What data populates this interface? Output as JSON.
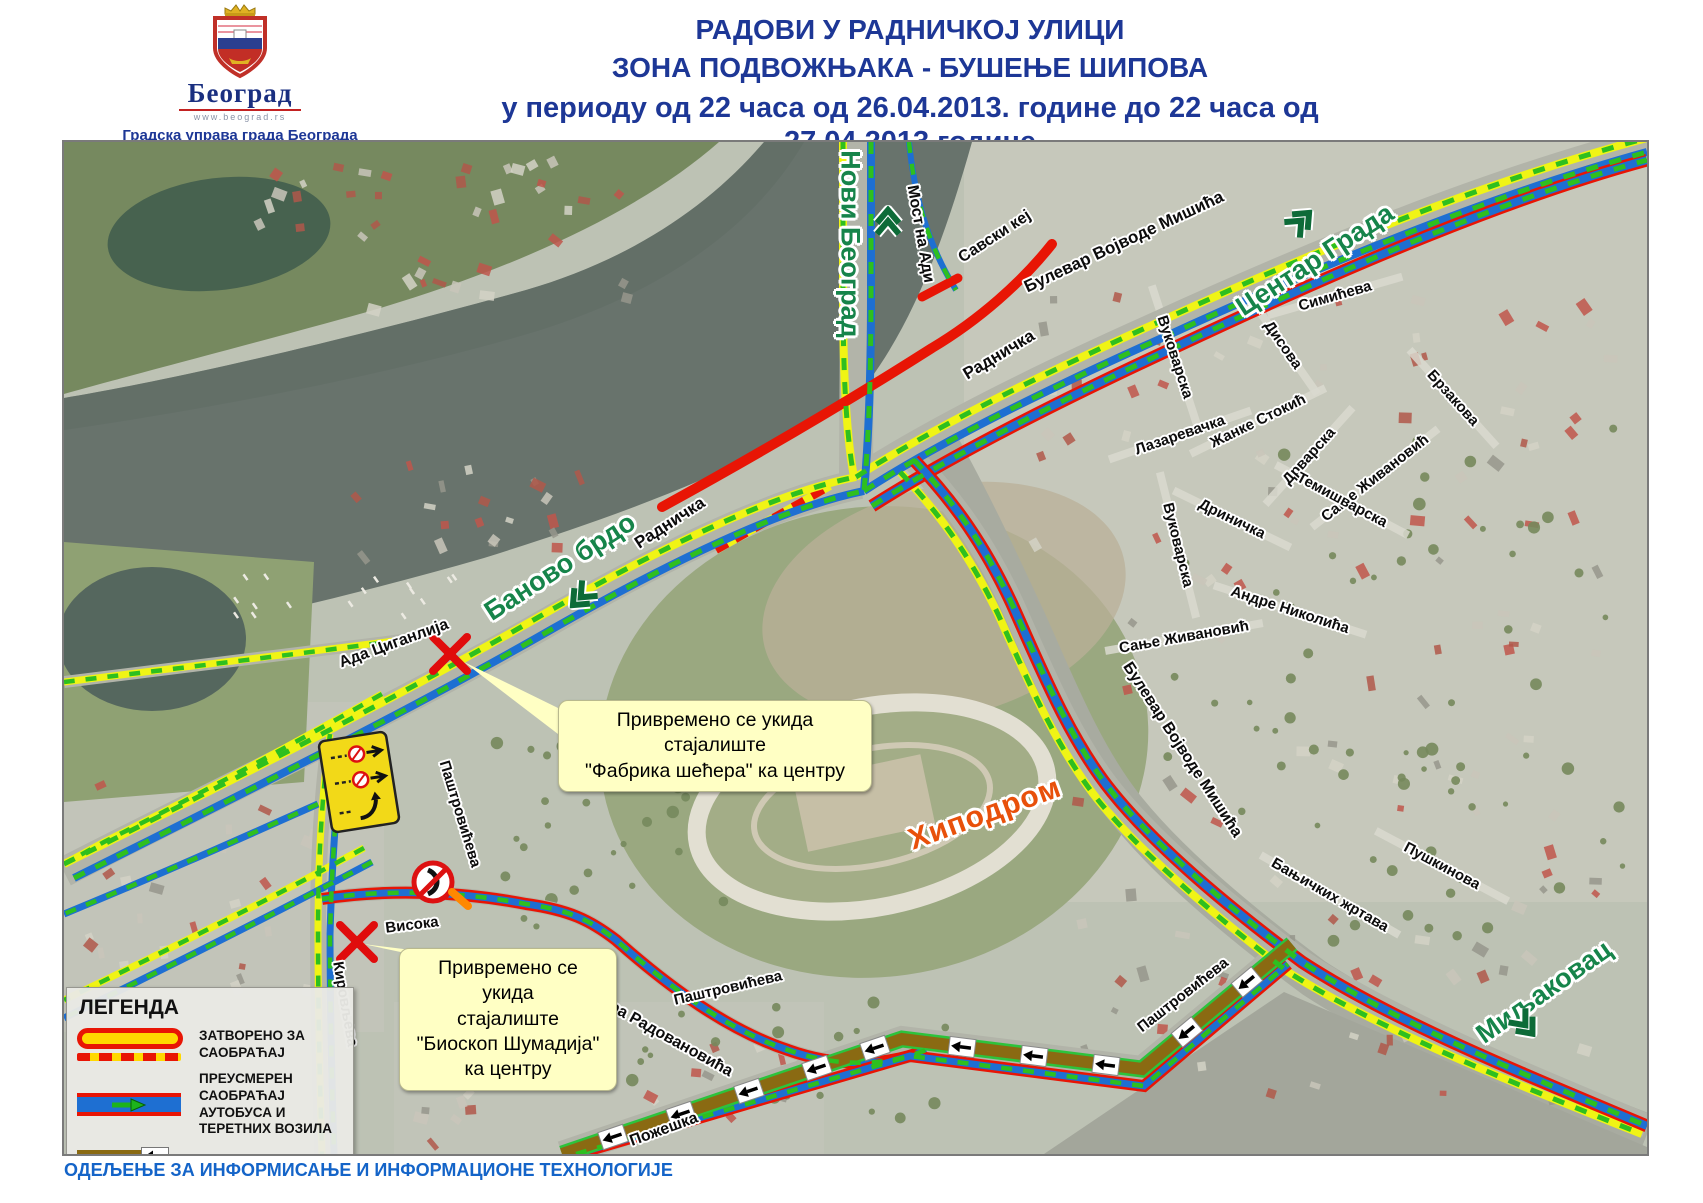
{
  "header": {
    "logo": {
      "city": "Београд",
      "url": "www.beograd.rs",
      "org1": "Градска управа града Београда",
      "org2": "Секретаријат за саобраћај"
    },
    "title1": "РАДОВИ У РАДНИЧКОЈ УЛИЦИ",
    "title2": "ЗОНА ПОДВОЖЊАКА - БУШЕЊЕ ШИПОВА",
    "title3": "у периоду од 22 часа од 26.04.2013. године до 22 часа од 27.04.2013.године"
  },
  "legend": {
    "title": "ЛЕГЕНДА",
    "items": [
      {
        "id": "closed",
        "label": "ЗАТВОРЕНО ЗА САОБРАЋАЈ"
      },
      {
        "id": "diverted",
        "label": "ПРЕУСМЕРЕН САОБРАЋАЈ\nАУТОБУСА И ТЕРЕТНИХ ВОЗИЛА"
      },
      {
        "id": "allowed",
        "label": "ДОЗВОЉЕН СМЕР"
      }
    ]
  },
  "footer": {
    "department": "ОДЕЉЕЊЕ ЗА ИНФОРМИСАЊЕ И ИНФОРМАЦИОНЕ ТЕХНОЛОГИЈЕ"
  },
  "map": {
    "callouts": [
      {
        "x": 494,
        "y": 558,
        "w": 292,
        "lines": "Привремено се укида стајалиште\n\"Фабрика шећера\" ка центру"
      },
      {
        "x": 335,
        "y": 806,
        "w": 196,
        "lines": "Привремено се укида\nстајалиште\n\"Биоскоп Шумадија\"\nка центру"
      }
    ],
    "area_label": {
      "text": "Хиподром",
      "x": 921,
      "y": 672,
      "rot": -20
    },
    "destinations": [
      {
        "text": "Нови Београд",
        "x": 786,
        "y": 102,
        "rot": 90,
        "ax": 824,
        "ay": 78,
        "adir": 0
      },
      {
        "text": "Центар Града",
        "x": 1251,
        "y": 118,
        "rot": -33,
        "ax": 1238,
        "ay": 78,
        "adir": 45
      },
      {
        "text": "Баново брдо",
        "x": 496,
        "y": 425,
        "rot": -33,
        "ax": 516,
        "ay": 456,
        "adir": 225
      },
      {
        "text": "Миљаковац",
        "x": 1480,
        "y": 850,
        "rot": -35,
        "ax": 1462,
        "ay": 884,
        "adir": 140
      }
    ],
    "streets": [
      {
        "text": "Мост на Ади",
        "x": 856,
        "y": 92,
        "rot": 80,
        "size": 16
      },
      {
        "text": "Савски кеј",
        "x": 931,
        "y": 95,
        "rot": -33,
        "size": 16
      },
      {
        "text": "Булевар Војводе Мишића",
        "x": 1060,
        "y": 100,
        "rot": -25,
        "size": 17
      },
      {
        "text": "Радничка",
        "x": 935,
        "y": 213,
        "rot": -31,
        "size": 17
      },
      {
        "text": "Радничка",
        "x": 606,
        "y": 381,
        "rot": -33,
        "size": 17
      },
      {
        "text": "Ада Циганлија",
        "x": 330,
        "y": 502,
        "rot": -20,
        "size": 16
      },
      {
        "text": "Паштровићева",
        "x": 396,
        "y": 672,
        "rot": 73,
        "size": 15
      },
      {
        "text": "Висока",
        "x": 348,
        "y": 783,
        "rot": -7,
        "size": 15
      },
      {
        "text": "Кировљева",
        "x": 281,
        "y": 862,
        "rot": 80,
        "size": 15
      },
      {
        "text": "Владимира Радовановића",
        "x": 575,
        "y": 880,
        "rot": 29,
        "size": 16
      },
      {
        "text": "Пожешка",
        "x": 600,
        "y": 988,
        "rot": -20,
        "size": 16
      },
      {
        "text": "Паштровићева",
        "x": 664,
        "y": 846,
        "rot": -13,
        "size": 15
      },
      {
        "text": "Паштровићева",
        "x": 1119,
        "y": 853,
        "rot": -38,
        "size": 15
      },
      {
        "text": "Булевар Војводе Мишића",
        "x": 1118,
        "y": 608,
        "rot": 57,
        "size": 16
      },
      {
        "text": "Бањичких жртава",
        "x": 1266,
        "y": 753,
        "rot": 30,
        "size": 15,
        "road": true,
        "len": 160
      },
      {
        "text": "Пушкинова",
        "x": 1378,
        "y": 724,
        "rot": 28,
        "size": 15,
        "road": true,
        "len": 150
      },
      {
        "text": "Вуковарска",
        "x": 1111,
        "y": 215,
        "rot": 72,
        "size": 15,
        "road": true,
        "len": 150
      },
      {
        "text": "Вуковарска",
        "x": 1114,
        "y": 403,
        "rot": 76,
        "size": 15,
        "road": true,
        "len": 150
      },
      {
        "text": "Лазаревачка",
        "x": 1116,
        "y": 293,
        "rot": -19,
        "size": 15,
        "road": true,
        "len": 150
      },
      {
        "text": "Жанке Стокић",
        "x": 1194,
        "y": 279,
        "rot": -26,
        "size": 15,
        "road": true,
        "len": 150
      },
      {
        "text": "Дрварска",
        "x": 1245,
        "y": 314,
        "rot": -48,
        "size": 15,
        "road": true,
        "len": 130
      },
      {
        "text": "Дриничка",
        "x": 1168,
        "y": 377,
        "rot": 26,
        "size": 15,
        "road": true,
        "len": 130
      },
      {
        "text": "Симићева",
        "x": 1271,
        "y": 154,
        "rot": -16,
        "size": 15,
        "road": true,
        "len": 140
      },
      {
        "text": "Дисова",
        "x": 1219,
        "y": 203,
        "rot": 55,
        "size": 15,
        "road": true,
        "len": 120
      },
      {
        "text": "Брзакова",
        "x": 1389,
        "y": 256,
        "rot": 48,
        "size": 15,
        "road": true,
        "len": 130
      },
      {
        "text": "Сање Живановић",
        "x": 1311,
        "y": 336,
        "rot": -38,
        "size": 15,
        "road": true,
        "len": 160
      },
      {
        "text": "Темишварска",
        "x": 1278,
        "y": 358,
        "rot": 28,
        "size": 15,
        "road": true,
        "len": 150
      },
      {
        "text": "Сање Живановић",
        "x": 1120,
        "y": 495,
        "rot": -10,
        "size": 15,
        "road": true,
        "len": 160
      },
      {
        "text": "Андре Николића",
        "x": 1226,
        "y": 468,
        "rot": 18,
        "size": 15,
        "road": true,
        "len": 160
      }
    ]
  },
  "colors": {
    "title_blue": "#1d3796",
    "footer_blue": "#1464c8",
    "route_yellow": "#f0f415",
    "route_blue": "#1e6fd2",
    "route_red": "#e81505",
    "arrow_green": "#2ebf1f",
    "route_brown": "#8a6a12",
    "destination_green": "#16844a",
    "hippodrome_orange": "#e8500a",
    "callout_bg": "#ffffc4"
  }
}
